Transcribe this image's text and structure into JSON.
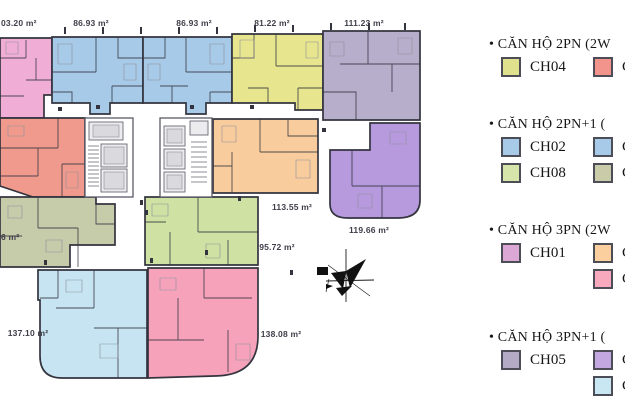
{
  "plan": {
    "wall_color": "#34343f",
    "unit_colors": {
      "u103": "#f0aed6",
      "u86a": "#a6cae7",
      "u86b": "#a6cae7",
      "u81": "#e7e68e",
      "u111": "#b7aecb",
      "salmon": "#f09a8d",
      "u113": "#f9cc9d",
      "u119": "#b69add",
      "u6": "#c6cbaa",
      "u95": "#cfe2a3",
      "u137": "#c6e4f1",
      "u138": "#f6a2bb"
    },
    "labels": {
      "u103": "03.20 m²",
      "u86a": "86.93 m²",
      "u86b": "86.93 m²",
      "u81": "81.22 m²",
      "u111": "111.23 m²",
      "u113": "113.55 m²",
      "u119": "119.66 m²",
      "u6": "6 m²",
      "u95": "95.72 m²",
      "u137": "137.10 m²",
      "u138": "138.08 m²"
    },
    "compass": "north-arrow"
  },
  "legend": {
    "sections": [
      {
        "title": "• CĂN HỘ 2PN (2W",
        "rows": [
          {
            "left_code": "CH04",
            "left_color": "#dfe18c",
            "right_code": "C",
            "right_color": "#f2948c"
          }
        ]
      },
      {
        "title": "• CĂN HỘ 2PN+1 (",
        "rows": [
          {
            "left_code": "CH02",
            "left_color": "#a6cae7",
            "right_code": "C",
            "right_color": "#a6cae7"
          },
          {
            "left_code": "CH08",
            "left_color": "#d6e6ab",
            "right_code": "C",
            "right_color": "#c9cba9"
          }
        ]
      },
      {
        "title": "• CĂN HỘ 3PN (2W",
        "rows": [
          {
            "left_code": "CH01",
            "left_color": "#dba8d6",
            "right_code": "C",
            "right_color": "#fbcf9e"
          },
          {
            "left_code": "",
            "left_color": "",
            "right_code": "C",
            "right_color": "#f8a9be"
          }
        ]
      },
      {
        "title": "• CĂN HỘ 3PN+1 (",
        "rows": [
          {
            "left_code": "CH05",
            "left_color": "#b5aac6",
            "right_code": "C",
            "right_color": "#c2a7e0"
          },
          {
            "left_code": "",
            "left_color": "",
            "right_code": "C",
            "right_color": "#c8e7f2"
          }
        ]
      }
    ]
  }
}
